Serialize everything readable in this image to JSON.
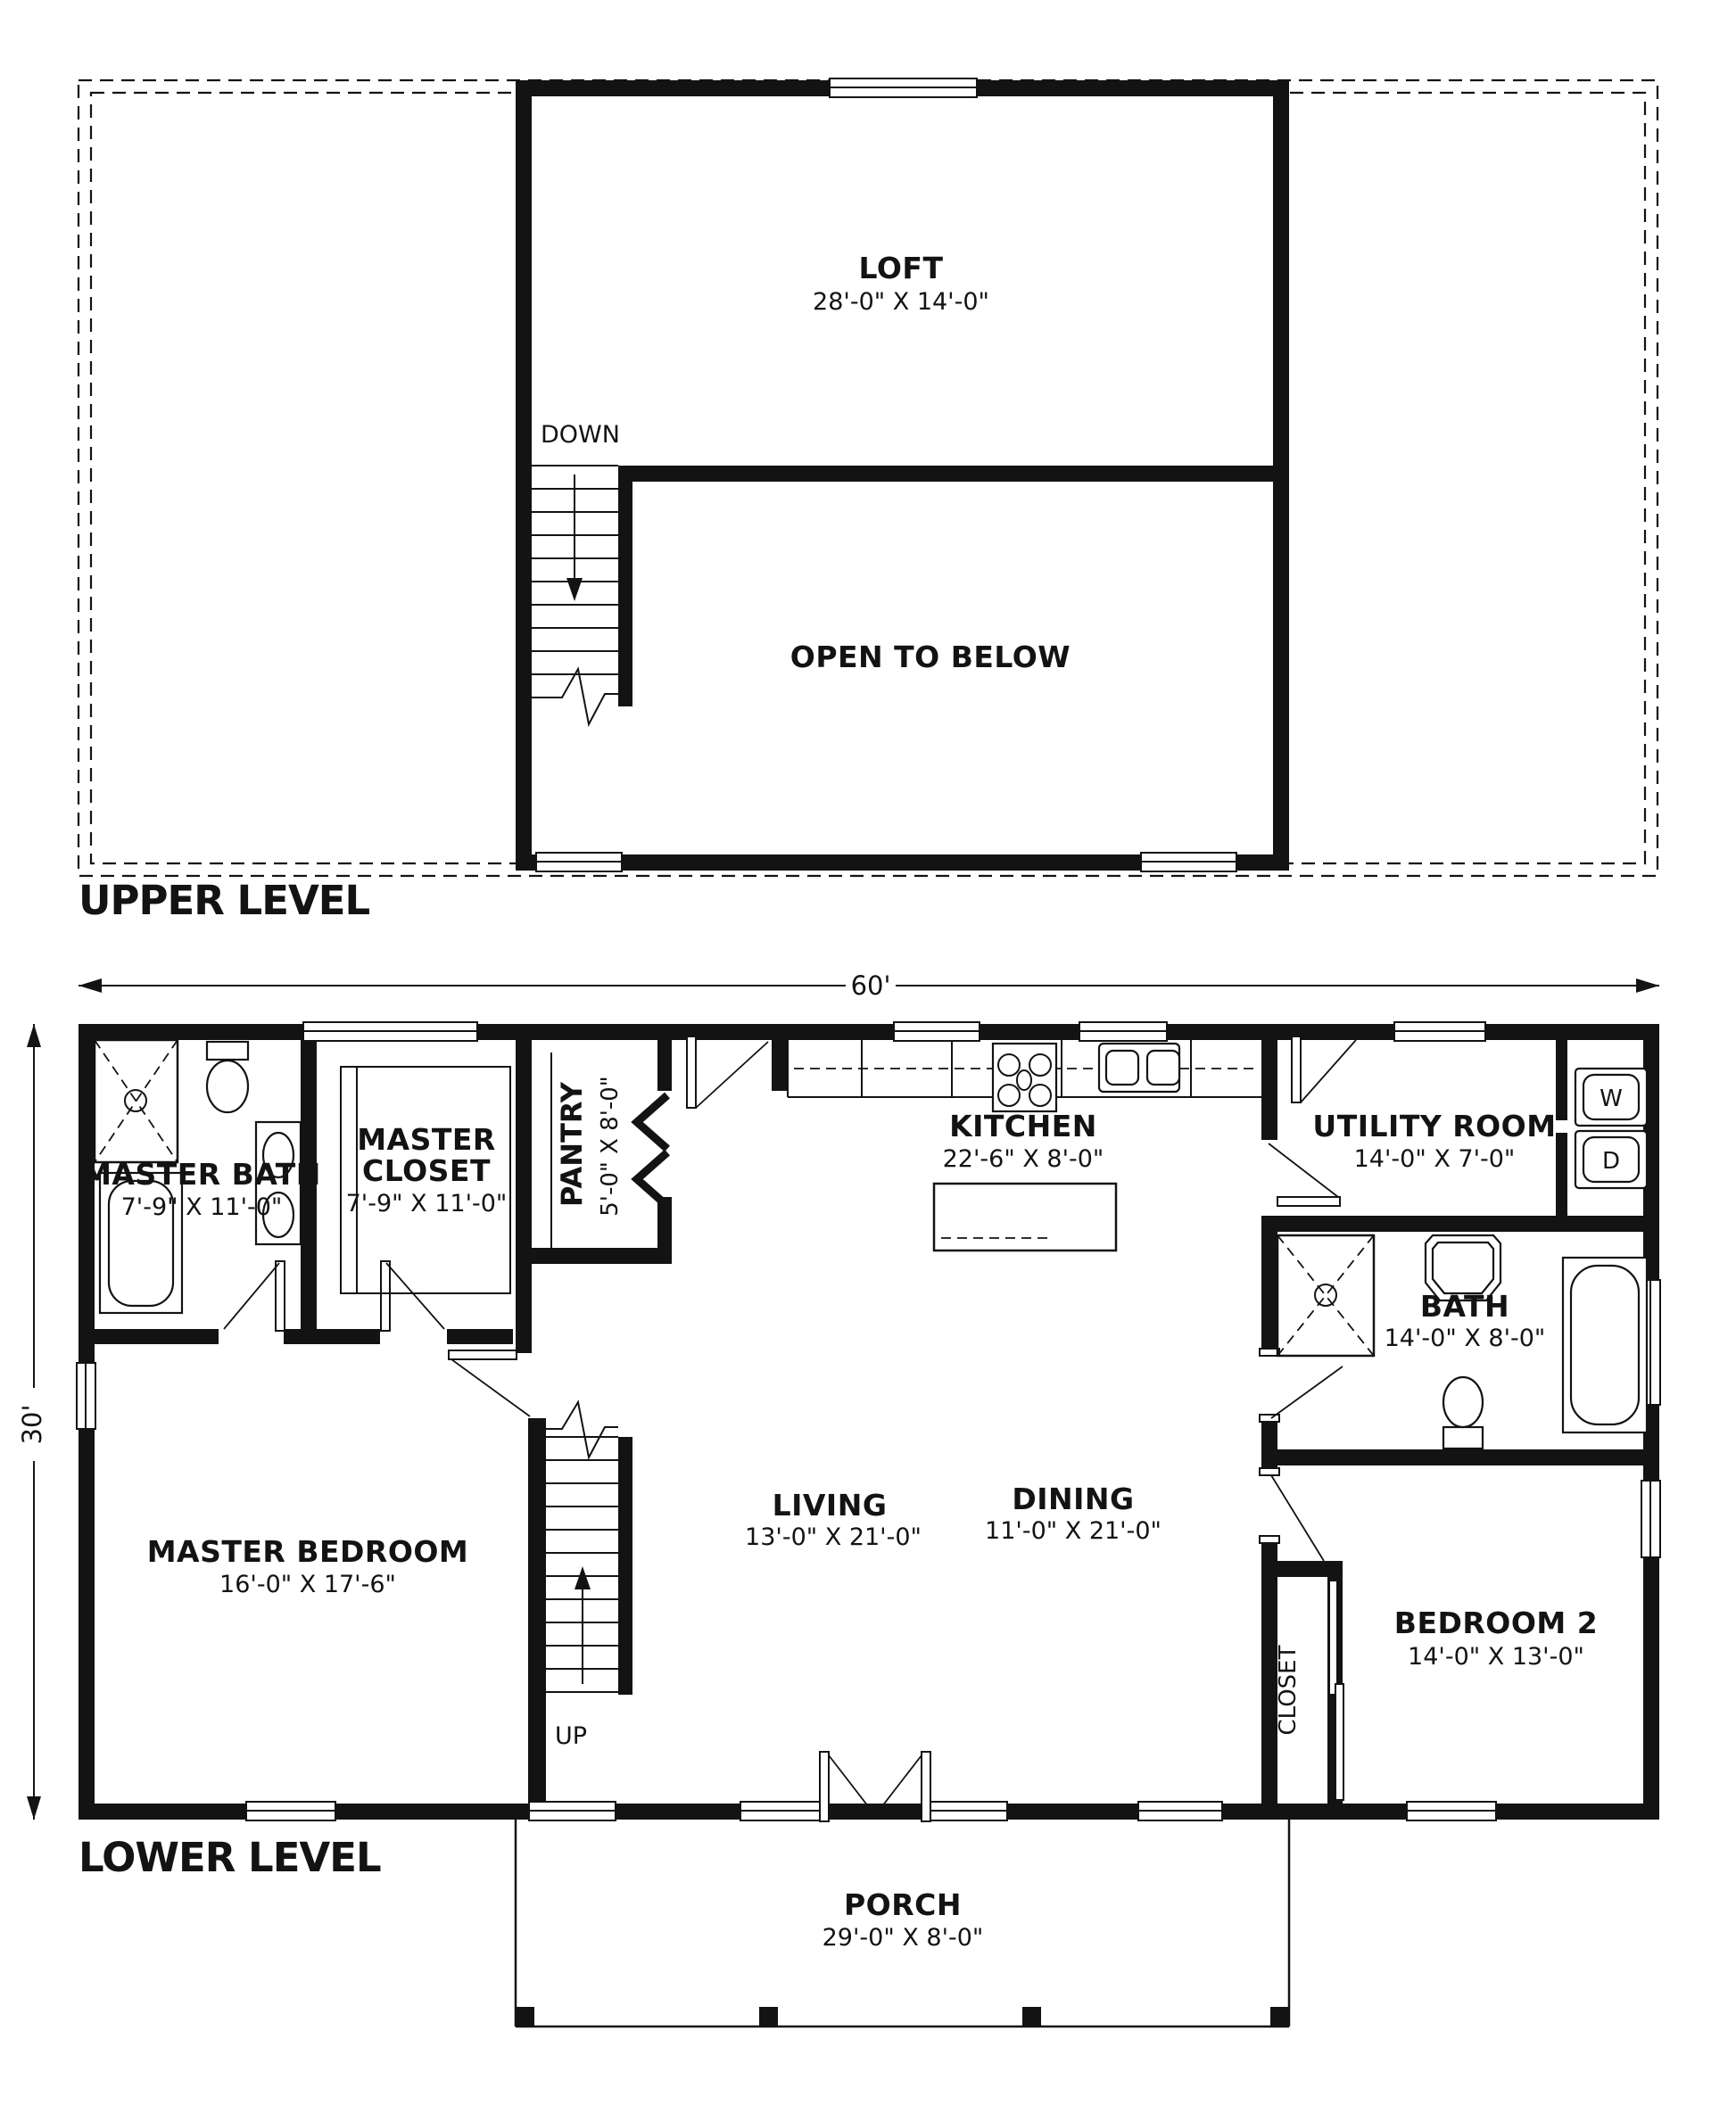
{
  "colors": {
    "ink": "#131313",
    "paper": "#ffffff"
  },
  "upper": {
    "level_label": "UPPER LEVEL",
    "stairs_label": "DOWN",
    "loft": {
      "name": "LOFT",
      "dims": "28'-0\" X 14'-0\""
    },
    "open_to_below": {
      "name": "OPEN TO BELOW"
    }
  },
  "lower": {
    "level_label": "LOWER LEVEL",
    "stairs_label": "UP",
    "dim_width": "60'",
    "dim_depth": "30'",
    "master_bath": {
      "name": "MASTER BATH",
      "dims": "7'-9\" X 11'-0\""
    },
    "master_closet": {
      "line1": "MASTER",
      "line2": "CLOSET",
      "dims": "7'-9\" X 11'-0\""
    },
    "pantry": {
      "name": "PANTRY",
      "dims": "5'-0\" X 8'-0\""
    },
    "kitchen": {
      "name": "KITCHEN",
      "dims": "22'-6\" X 8'-0\""
    },
    "utility_room": {
      "name": "UTILITY ROOM",
      "dims": "14'-0\" X 7'-0\""
    },
    "bath": {
      "name": "BATH",
      "dims": "14'-0\" X 8'-0\""
    },
    "living": {
      "name": "LIVING",
      "dims": "13'-0\" X 21'-0\""
    },
    "dining": {
      "name": "DINING",
      "dims": "11'-0\" X 21'-0\""
    },
    "master_bedroom": {
      "name": "MASTER BEDROOM",
      "dims": "16'-0\" X 17'-6\""
    },
    "bedroom_2": {
      "name": "BEDROOM 2",
      "dims": "14'-0\" X 13'-0\""
    },
    "closet": {
      "name": "CLOSET"
    },
    "porch": {
      "name": "PORCH",
      "dims": "29'-0\" X 8'-0\""
    },
    "washer": "W",
    "dryer": "D"
  }
}
